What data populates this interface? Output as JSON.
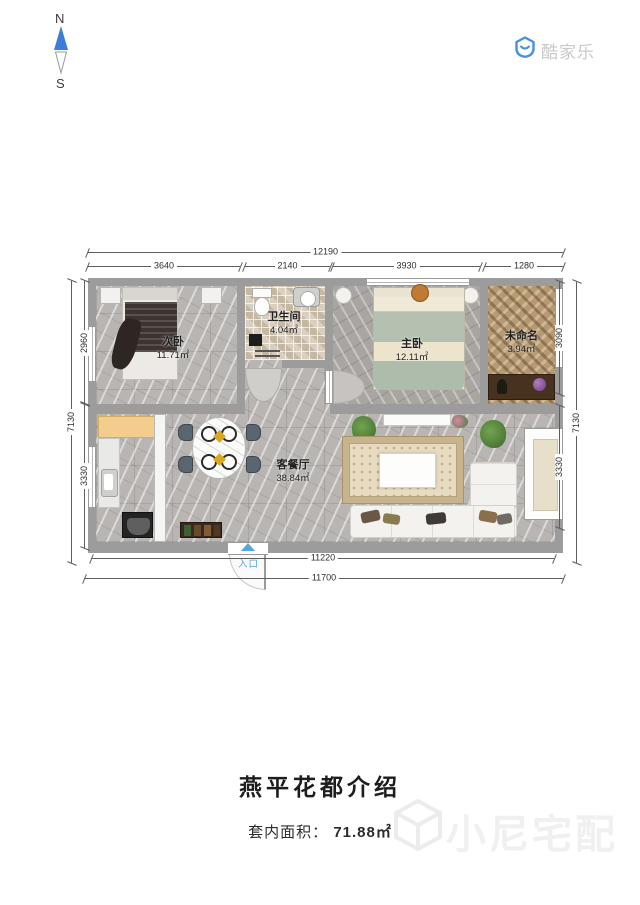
{
  "compass": {
    "north": "N",
    "south": "S"
  },
  "logo": {
    "text": "酷家乐"
  },
  "plan": {
    "rooms": [
      {
        "name": "次卧",
        "area": "11.71㎡"
      },
      {
        "name": "卫生间",
        "area": "4.04㎡"
      },
      {
        "name": "主卧",
        "area": "12.11㎡"
      },
      {
        "name": "未命名",
        "area": "3.94㎡"
      },
      {
        "name": "客餐厅",
        "area": "38.84㎡"
      }
    ],
    "entrance_label": "入口",
    "dimensions": {
      "top_total": "12190",
      "top_segments": [
        "3640",
        "2140",
        "3930",
        "1280"
      ],
      "left_total": "7130",
      "left_segments": [
        "2960",
        "3330"
      ],
      "right_total": "7130",
      "right_segments": [
        "3090",
        "3330"
      ],
      "bottom_inner": "11220",
      "bottom_outer": "11700"
    }
  },
  "footer": {
    "title": "燕平花都介绍",
    "area_label": "套内面积：",
    "area_value": "71.88㎡"
  },
  "watermark": {
    "text": "小尼宅配"
  },
  "colors": {
    "compass_blue": "#3b7dd8",
    "logo_blue": "#4a90e2",
    "entrance_blue": "#56a5dc",
    "wall_gray": "#9c9c9c"
  }
}
